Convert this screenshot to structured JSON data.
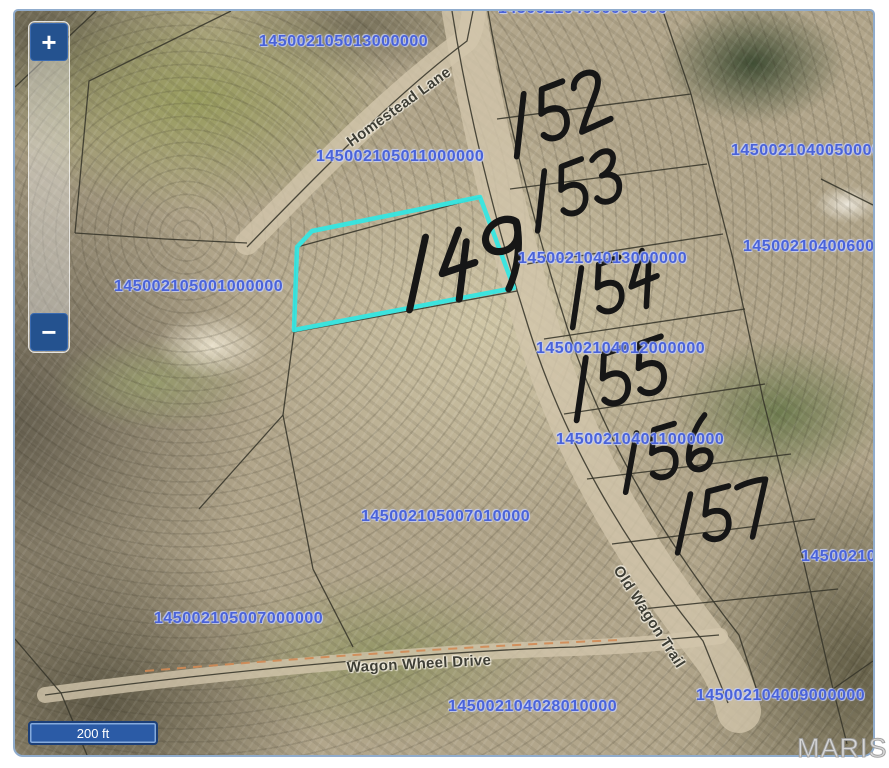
{
  "window": {
    "watermark": "MARIS"
  },
  "controls": {
    "zoom_in": "+",
    "zoom_out": "−",
    "scale_bar": "200 ft"
  },
  "colors": {
    "highlight_outline": "#35e6e2",
    "parcel_label_blue": "#4a63d8",
    "annotation_ink": "#161616",
    "control_navy": "#24528f",
    "scale_bar_fill": "#2b5ba6"
  },
  "parcels": [
    {
      "text": "145002105013000000",
      "x": 244,
      "y": 22
    },
    {
      "text": "145002105011000000",
      "x": 301,
      "y": 137
    },
    {
      "text": "145002105001000000",
      "x": 99,
      "y": 267
    },
    {
      "text": "145002104013000000",
      "x": 503,
      "y": 239
    },
    {
      "text": "1450021040050000",
      "x": 716,
      "y": 131
    },
    {
      "text": "145002104006000",
      "x": 728,
      "y": 227
    },
    {
      "text": "145002104012000000",
      "x": 521,
      "y": 329
    },
    {
      "text": "145002104011000000",
      "x": 541,
      "y": 420
    },
    {
      "text": "145002105007010000",
      "x": 346,
      "y": 497
    },
    {
      "text": "145002105007000000",
      "x": 139,
      "y": 599
    },
    {
      "text": "145002104028010000",
      "x": 433,
      "y": 687
    },
    {
      "text": "145002104009000000",
      "x": 681,
      "y": 676
    },
    {
      "text": "145002104",
      "x": 786,
      "y": 537
    },
    {
      "text": "145002104000000000",
      "x": 483,
      "y": -11
    }
  ],
  "streets": [
    {
      "text": "Homestead Lane",
      "x": 384,
      "y": 96,
      "rotate": -36
    },
    {
      "text": "Wagon Wheel Drive",
      "x": 404,
      "y": 653,
      "rotate": -3
    },
    {
      "text": "Old Wagon Trail",
      "x": 634,
      "y": 606,
      "rotate": 57
    }
  ],
  "lot_numbers": [
    {
      "text": "149",
      "x": 374,
      "y": 226,
      "rotate": -12,
      "scale": 1.3
    },
    {
      "text": "152",
      "x": 478,
      "y": 86,
      "rotate": -18,
      "scale": 1.1
    },
    {
      "text": "153",
      "x": 500,
      "y": 163,
      "rotate": -18,
      "scale": 1.05
    },
    {
      "text": "154",
      "x": 537,
      "y": 259,
      "rotate": -16,
      "scale": 1.05
    },
    {
      "text": "155",
      "x": 540,
      "y": 349,
      "rotate": -16,
      "scale": 1.1
    },
    {
      "text": "156",
      "x": 592,
      "y": 423,
      "rotate": -14,
      "scale": 1.05
    },
    {
      "text": "157",
      "x": 646,
      "y": 483,
      "rotate": -12,
      "scale": 1.05
    }
  ]
}
